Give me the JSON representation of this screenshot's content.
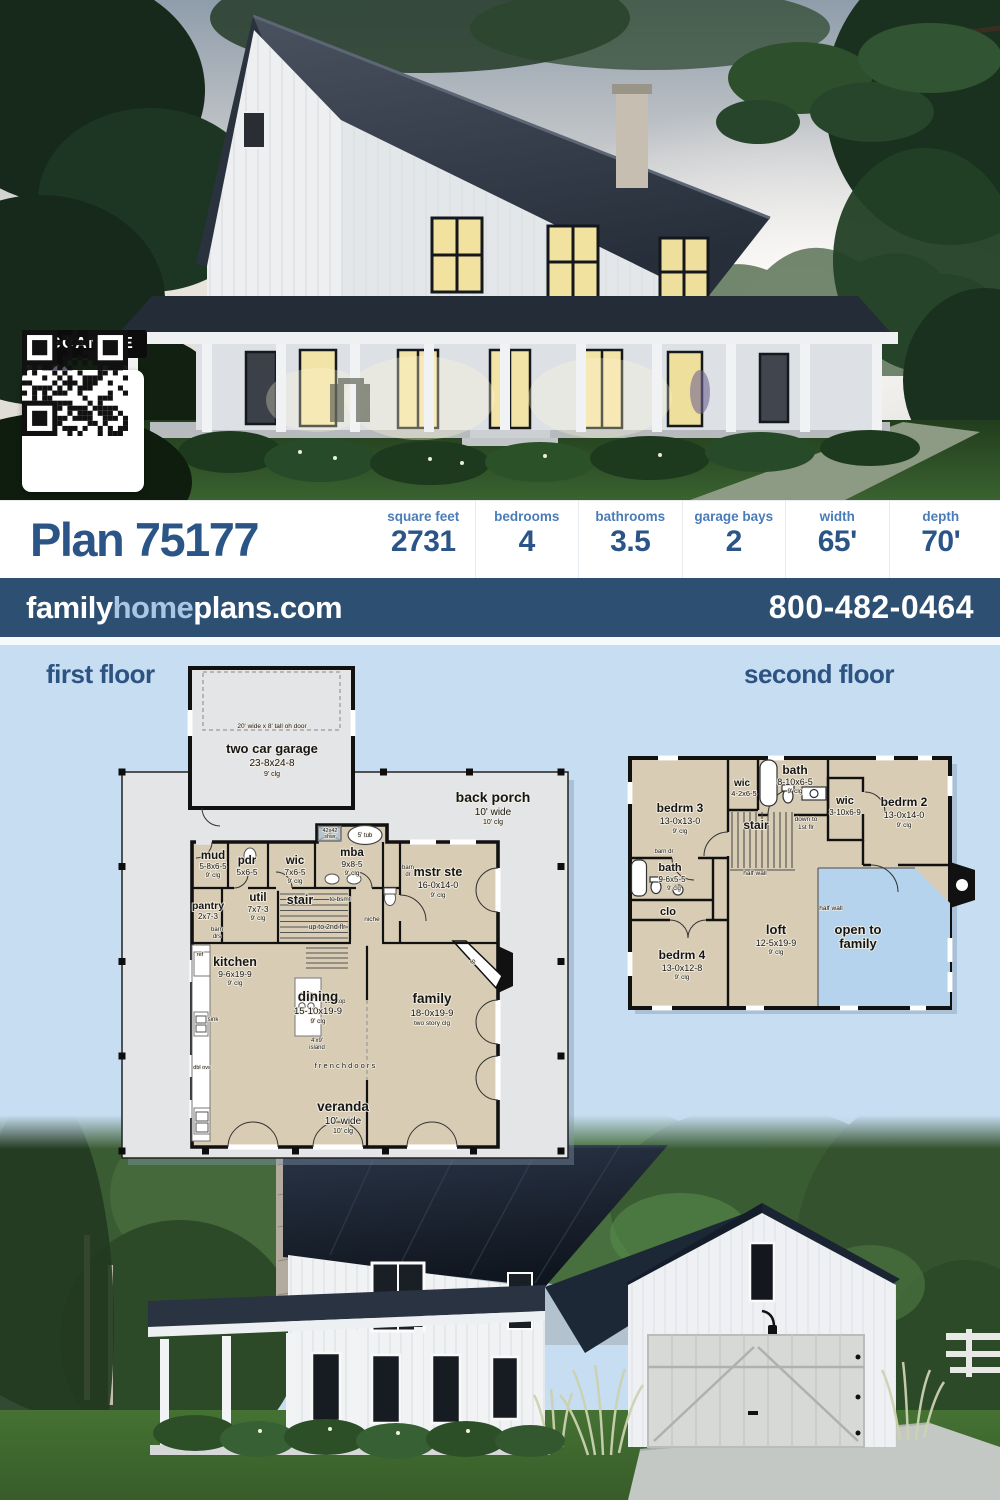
{
  "header": {
    "plan_title": "Plan 75177",
    "stats": [
      {
        "label": "square feet",
        "value": "2731"
      },
      {
        "label": "bedrooms",
        "value": "4"
      },
      {
        "label": "bathrooms",
        "value": "3.5"
      },
      {
        "label": "garage bays",
        "value": "2"
      },
      {
        "label": "width",
        "value": "65'"
      },
      {
        "label": "depth",
        "value": "70'"
      }
    ]
  },
  "brand_bar": {
    "family": "family",
    "home": "home",
    "plans": "plans.com",
    "phone": "800-482-0464"
  },
  "photo_top": {
    "qr_label": "SCAN ME"
  },
  "sections": {
    "first_floor": "first floor",
    "second_floor": "second floor"
  },
  "first_floor": {
    "garage_door_note": "20' wide x 8' tall oh door",
    "garage": {
      "name": "two car garage",
      "dims": "23-8x24-8",
      "clg": "9' clg"
    },
    "back_porch": {
      "name": "back porch",
      "width": "10' wide",
      "clg": "10' clg"
    },
    "mud": {
      "name": "mud",
      "dims": "5-8x6-5",
      "clg": "9' clg"
    },
    "pdr": {
      "name": "pdr",
      "dims": "5x6-5"
    },
    "wic": {
      "name": "wic",
      "dims": "7x6-5",
      "clg": "9' clg"
    },
    "mba": {
      "name": "mba",
      "dims": "9x8-5",
      "clg": "9' clg"
    },
    "shwr_l1": "42x42",
    "shwr_l2": "shwr",
    "tub": "5' tub",
    "mstr": {
      "name": "mstr ste",
      "dims": "16-0x14-0",
      "clg": "9' clg"
    },
    "barn_dr_l1": "barn",
    "barn_dr_l2": "dr",
    "pantry": {
      "name": "pantry",
      "dims": "2x7-3"
    },
    "pantry_note_l1": "barn",
    "pantry_note_l2": "drs",
    "util": {
      "name": "util",
      "dims": "7x7-3",
      "clg": "9' clg"
    },
    "stair": "stair",
    "to_bsmt": "to bsmt",
    "up_note": "up to 2nd flr",
    "niche": "niche",
    "kitchen": {
      "name": "kitchen",
      "dims": "9-6x19-9",
      "clg": "9' clg"
    },
    "ref": "ref",
    "cooktop": "cooktop",
    "sink": "sink",
    "island_l1": "4'x9'",
    "island_l2": "island",
    "dbl_ovs": "dbl ovs",
    "dining": {
      "name": "dining",
      "dims": "15-10x19-9",
      "clg": "9' clg"
    },
    "family": {
      "name": "family",
      "dims": "18-0x19-9",
      "clg": "two story clg"
    },
    "fp": "fp",
    "french_doors": "f r e n c h   d o o r s",
    "veranda": {
      "name": "veranda",
      "width": "10' wide",
      "clg": "10' clg"
    }
  },
  "second_floor": {
    "bedrm3": {
      "name": "bedrm 3",
      "dims": "13-0x13-0",
      "clg": "9' clg"
    },
    "wic_top": {
      "name": "wic",
      "dims": "4-2x6-5"
    },
    "bath_top": {
      "name": "bath",
      "dims": "8-10x6-5",
      "clg": "9' clg"
    },
    "wic_mid": {
      "name": "wic",
      "dims": "3-10x6-9"
    },
    "bedrm2": {
      "name": "bedrm 2",
      "dims": "13-0x14-0",
      "clg": "9' clg"
    },
    "stair": "stair",
    "down_l1": "down to",
    "down_l2": "1st flr",
    "barn_dr": "barn dr",
    "bath_left": {
      "name": "bath",
      "dims": "9-6x5-5",
      "clg": "9' clg"
    },
    "clo": "clo",
    "half_wall": "half wall",
    "bedrm4": {
      "name": "bedrm 4",
      "dims": "13-0x12-8",
      "clg": "9' clg"
    },
    "loft": {
      "name": "loft",
      "dims": "12-5x19-9",
      "clg": "9' clg"
    },
    "open_l1": "open to",
    "open_l2": "family"
  },
  "colors": {
    "accent_navy": "#2d4f72",
    "title_blue": "#2b5586",
    "label_blue": "#4a7cb8",
    "plan_bg_blue": "#c7ddf2",
    "floor_tan": "#d8ccb4",
    "porch_gray": "#e4e5e7",
    "open_blue": "#b6d3ee"
  }
}
